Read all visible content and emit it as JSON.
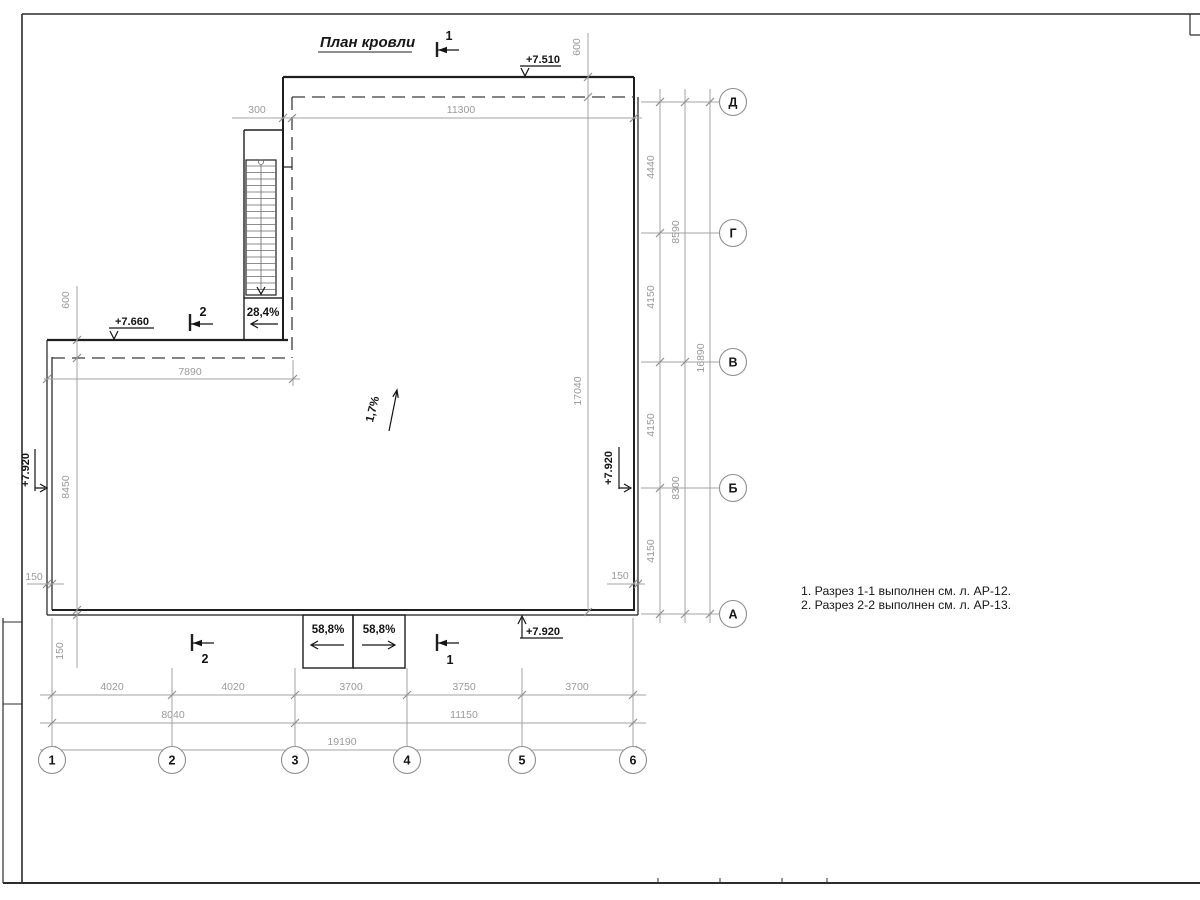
{
  "title": "План кровли",
  "notes": {
    "line1": "1. Разрез 1-1 выполнен см. л. АР-12.",
    "line2": "2. Разрез 2-2 выполнен см. л. АР-13."
  },
  "grid": {
    "row_axes": [
      "Д",
      "Г",
      "В",
      "Б",
      "А"
    ],
    "col_axes": [
      "1",
      "2",
      "3",
      "4",
      "5",
      "6"
    ]
  },
  "elevations": {
    "top": "+7.510",
    "wing": "+7.660",
    "left": "+7.920",
    "right": "+7.920",
    "bottom": "+7.920"
  },
  "slopes": {
    "stair": "28,4%",
    "roof": "1,7%",
    "ramp_left": "58,8%",
    "ramp_right": "58,8%"
  },
  "sections": {
    "top": "1",
    "wing": "2",
    "bottom_left": "2",
    "bottom_right": "1"
  },
  "dims": {
    "top": {
      "d300": "300",
      "d11300": "11300",
      "d600": "600"
    },
    "left": {
      "d600": "600",
      "d7890": "7890",
      "d8450": "8450",
      "d150h": "150",
      "d150v": "150"
    },
    "center": {
      "d17040": "17040"
    },
    "right": {
      "col1": [
        "4440",
        "4150",
        "4150",
        "4150"
      ],
      "col2": [
        "8590",
        "8300"
      ],
      "col3": "16890",
      "d150": "150"
    },
    "bottom": {
      "row1": [
        "4020",
        "4020",
        "3700",
        "3750",
        "3700"
      ],
      "row2": [
        "8040",
        "11150"
      ],
      "row3": "19190"
    }
  },
  "colors": {
    "line": "#1f1f1f",
    "dim": "#a3a3a3",
    "bg": "#ffffff"
  }
}
